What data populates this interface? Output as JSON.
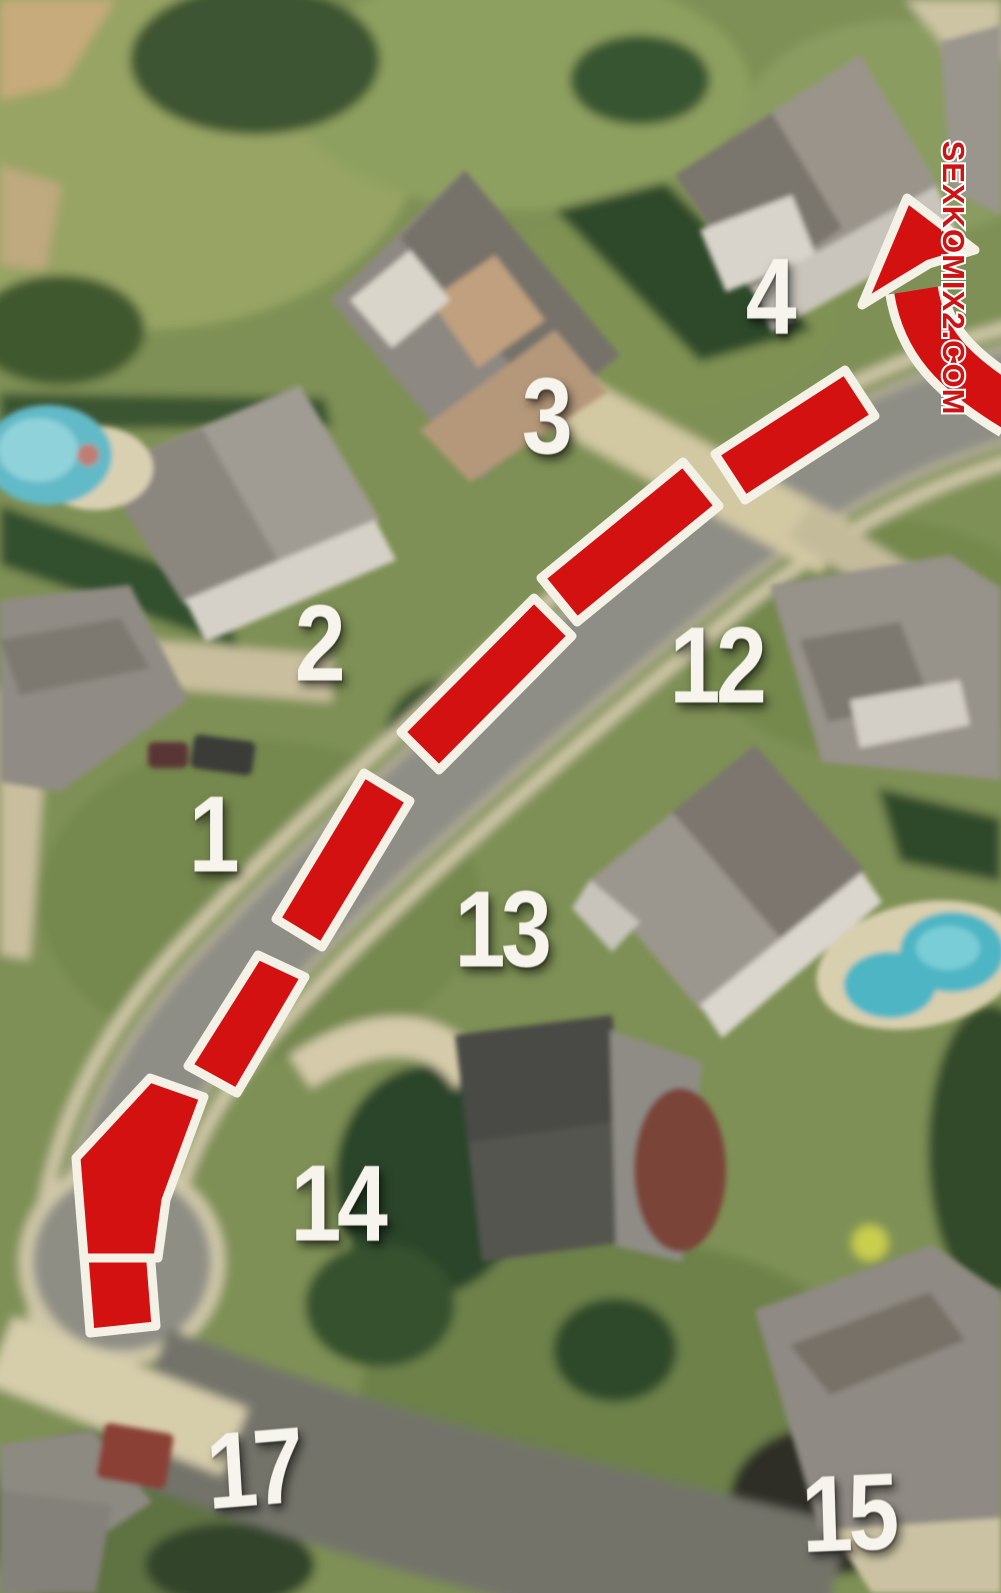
{
  "watermark": {
    "text": "SEXKOMIX2.COM",
    "color": "#cf1213",
    "outline_color": "#ffffff"
  },
  "route": {
    "style": "dashed-arrow",
    "fill_color": "#d41111",
    "outline_color": "#f4f1e6",
    "arrow_direction": "up-right",
    "dash_count": 7
  },
  "labels": {
    "n1": "1",
    "n2": "2",
    "n3": "3",
    "n4": "4",
    "n12": "12",
    "n13": "13",
    "n14": "14",
    "n15": "15",
    "n17": "17"
  }
}
